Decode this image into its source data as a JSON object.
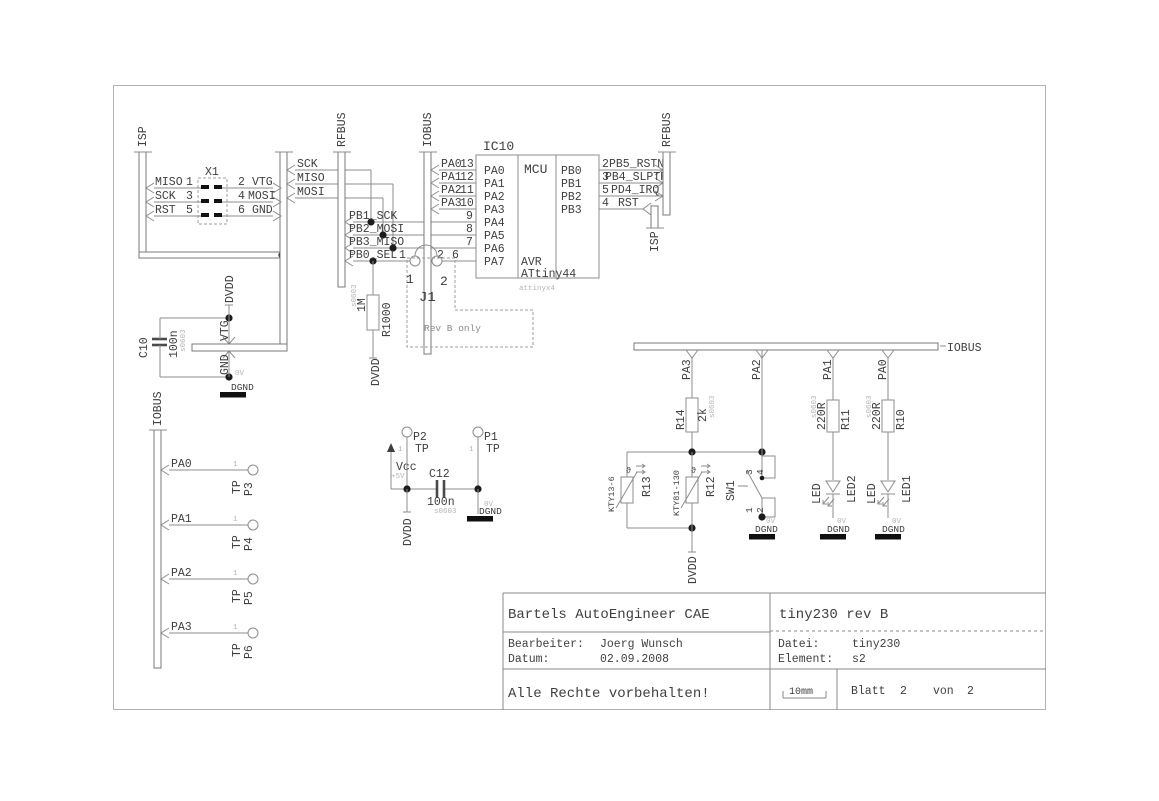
{
  "buses": {
    "isp_left": "ISP",
    "rfbus_left": "RFBUS",
    "iobus_mcu": "IOBUS",
    "rfbus_right": "RFBUS",
    "isp_right": "ISP",
    "iobus_bottom": "IOBUS",
    "iobus_right": "IOBUS"
  },
  "x1": {
    "ref": "X1",
    "rows": [
      {
        "l_sig": "MISO",
        "l_pin": "1",
        "r_pin": "2",
        "r_sig": "VTG"
      },
      {
        "l_sig": "SCK",
        "l_pin": "3",
        "r_pin": "4",
        "r_sig": "MOSI"
      },
      {
        "l_sig": "RST",
        "l_pin": "5",
        "r_pin": "6",
        "r_sig": "GND"
      }
    ]
  },
  "nets": {
    "sck": "SCK",
    "miso": "MISO",
    "mosi": "MOSI",
    "pb1": "PB1_SCK",
    "pb2": "PB2_MOSI",
    "pb3": "PB3_MISO",
    "pb0": "PB0_SEL",
    "pb0_pin": "1",
    "dvdd": "DVDD",
    "vtg": "VTG",
    "gnd": "GND",
    "dgnd": "DGND",
    "zerov": "0V",
    "vcc": "Vcc",
    "plus5v": "+5V"
  },
  "mcu": {
    "ref": "IC10",
    "title": "MCU",
    "family": "AVR",
    "part": "ATtiny44",
    "footprint": "attinyx4",
    "left": [
      {
        "bus": "PA0",
        "num": "13",
        "name": "PA0"
      },
      {
        "bus": "PA1",
        "num": "12",
        "name": "PA1"
      },
      {
        "bus": "PA2",
        "num": "11",
        "name": "PA2"
      },
      {
        "bus": "PA3",
        "num": "10",
        "name": "PA3"
      },
      {
        "bus": "",
        "num": "9",
        "name": "PA4"
      },
      {
        "bus": "",
        "num": "8",
        "name": "PA5"
      },
      {
        "bus": "",
        "num": "7",
        "name": "PA6"
      },
      {
        "bus": "",
        "num": "6",
        "name": "PA7"
      }
    ],
    "right": [
      {
        "name": "PB0",
        "num": "2",
        "sig": "PB5_RSTN"
      },
      {
        "name": "PB1",
        "num": "3",
        "sig": "PB4_SLPTR"
      },
      {
        "name": "PB2",
        "num": "5",
        "sig": "PD4_IRQ"
      },
      {
        "name": "PB3",
        "num": "4",
        "sig": "RST"
      }
    ]
  },
  "j1": {
    "ref": "J1",
    "pad1": "1",
    "pad2": "2",
    "pin2": "2",
    "note": "Rev B only"
  },
  "r1000": {
    "ref": "R1000",
    "value": "1M",
    "pkg": "s0603"
  },
  "c10": {
    "ref": "C10",
    "value": "100n",
    "pkg": "s0603"
  },
  "c12": {
    "ref": "C12",
    "value": "100n",
    "pkg": "s0603"
  },
  "testpoints": {
    "left": [
      {
        "net": "PA0",
        "type": "TP",
        "name": "P3",
        "pin": "1"
      },
      {
        "net": "PA1",
        "type": "TP",
        "name": "P4",
        "pin": "1"
      },
      {
        "net": "PA2",
        "type": "TP",
        "name": "P5",
        "pin": "1"
      },
      {
        "net": "PA3",
        "type": "TP",
        "name": "P6",
        "pin": "1"
      }
    ],
    "mid": [
      {
        "name": "P2",
        "type": "TP",
        "pin": "1"
      },
      {
        "name": "P1",
        "type": "TP",
        "pin": "1"
      }
    ]
  },
  "right_section": {
    "taps": [
      "PA3",
      "PA2",
      "PA1",
      "PA0"
    ],
    "r14": {
      "ref": "R14",
      "value": "2k",
      "pkg": "s0603"
    },
    "r13": {
      "ref": "R13",
      "part": "KTY13-6",
      "symbol": "ϑ"
    },
    "r12": {
      "ref": "R12",
      "part": "KTY81-130",
      "symbol": "ϑ"
    },
    "sw1": {
      "ref": "SW1",
      "p1": "1",
      "p2": "2",
      "p3": "3",
      "p4": "4"
    },
    "r11": {
      "ref": "R11",
      "value": "220R",
      "pkg": "s0603"
    },
    "r10": {
      "ref": "R10",
      "value": "220R",
      "pkg": "s0603"
    },
    "led2": {
      "ref": "LED2",
      "value": "LED"
    },
    "led1": {
      "ref": "LED1",
      "value": "LED"
    }
  },
  "title_block": {
    "producer": "Bartels AutoEngineer CAE",
    "bearbeiter_label": "Bearbeiter:",
    "bearbeiter": "Joerg Wunsch",
    "datum_label": "Datum:",
    "datum": "02.09.2008",
    "rights": "Alle Rechte vorbehalten!",
    "title": "tiny230 rev B",
    "datei_label": "Datei:",
    "datei": "tiny230",
    "element_label": "Element:",
    "element": "s2",
    "scale": "10mm",
    "blatt_label": "Blatt",
    "blatt": "2",
    "von_label": "von",
    "von_total": "2"
  }
}
